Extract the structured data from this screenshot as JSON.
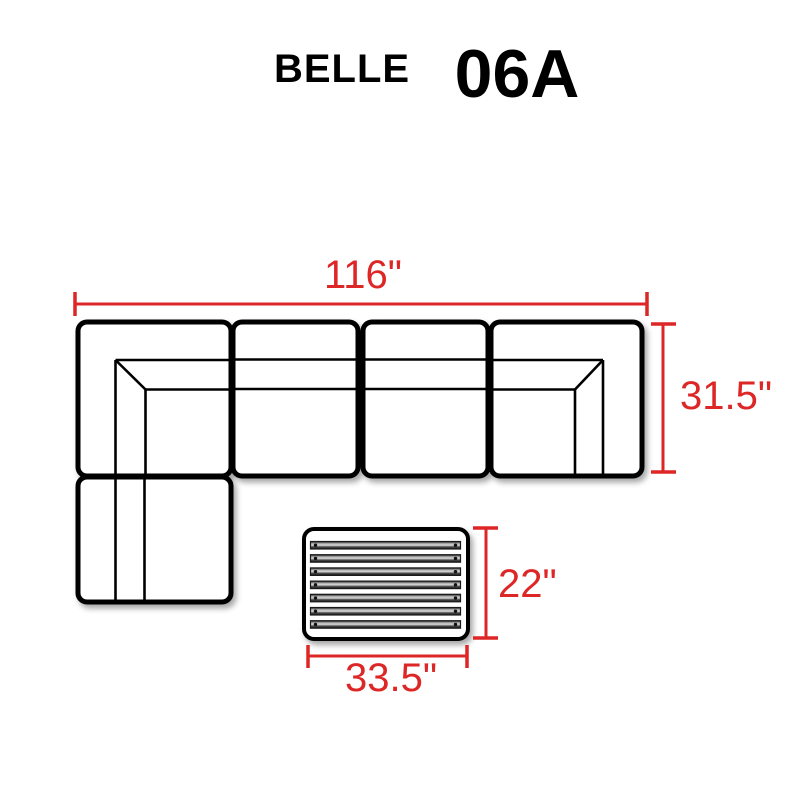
{
  "page": {
    "background": "#ffffff"
  },
  "header": {
    "collection_name": "BELLE",
    "set_code": "06A"
  },
  "colors": {
    "dimension_red": "#dd2626",
    "outline_black": "#000000"
  },
  "diagram": {
    "sofa": {
      "pieces": [
        {
          "name": "left-corner-sofa"
        },
        {
          "name": "armless-middle-sofa-1"
        },
        {
          "name": "armless-middle-sofa-2"
        },
        {
          "name": "right-corner-sofa"
        },
        {
          "name": "left-side-armless-sofa"
        }
      ]
    },
    "coffee_table": {
      "slat_count": 7
    },
    "dimensions": {
      "overall_width": "116\"",
      "overall_depth": "31.5\"",
      "table_depth": "22\"",
      "table_width": "33.5\""
    }
  }
}
